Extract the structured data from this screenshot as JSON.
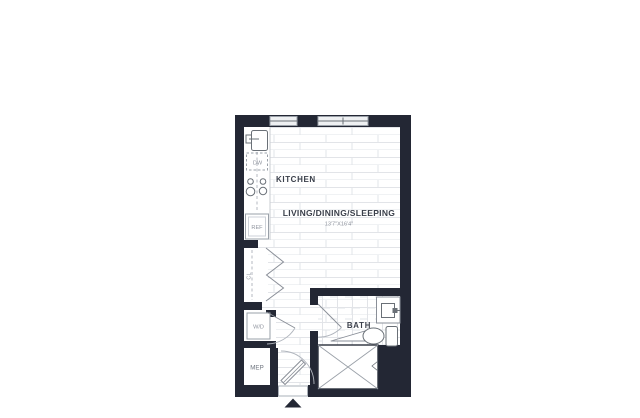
{
  "title": "Studio apartment floor plan",
  "labels": {
    "kitchen": "KITCHEN",
    "living": "LIVING/DINING/SLEEPING",
    "living_dimensions": "13'7\"X16'4\"",
    "bath": "BATH",
    "closet": "CL",
    "washer_dryer": "W/D",
    "mep": "MEP",
    "dishwasher": "DW",
    "refrigerator": "REF"
  },
  "colors": {
    "wall": "#232734",
    "floor_line": "#e2e4e8",
    "fixture_stroke": "#6a7077",
    "door_stroke": "#8a8f98",
    "label_dark": "#3a3f4a",
    "label_muted": "#8f949e",
    "background": "#ffffff"
  }
}
